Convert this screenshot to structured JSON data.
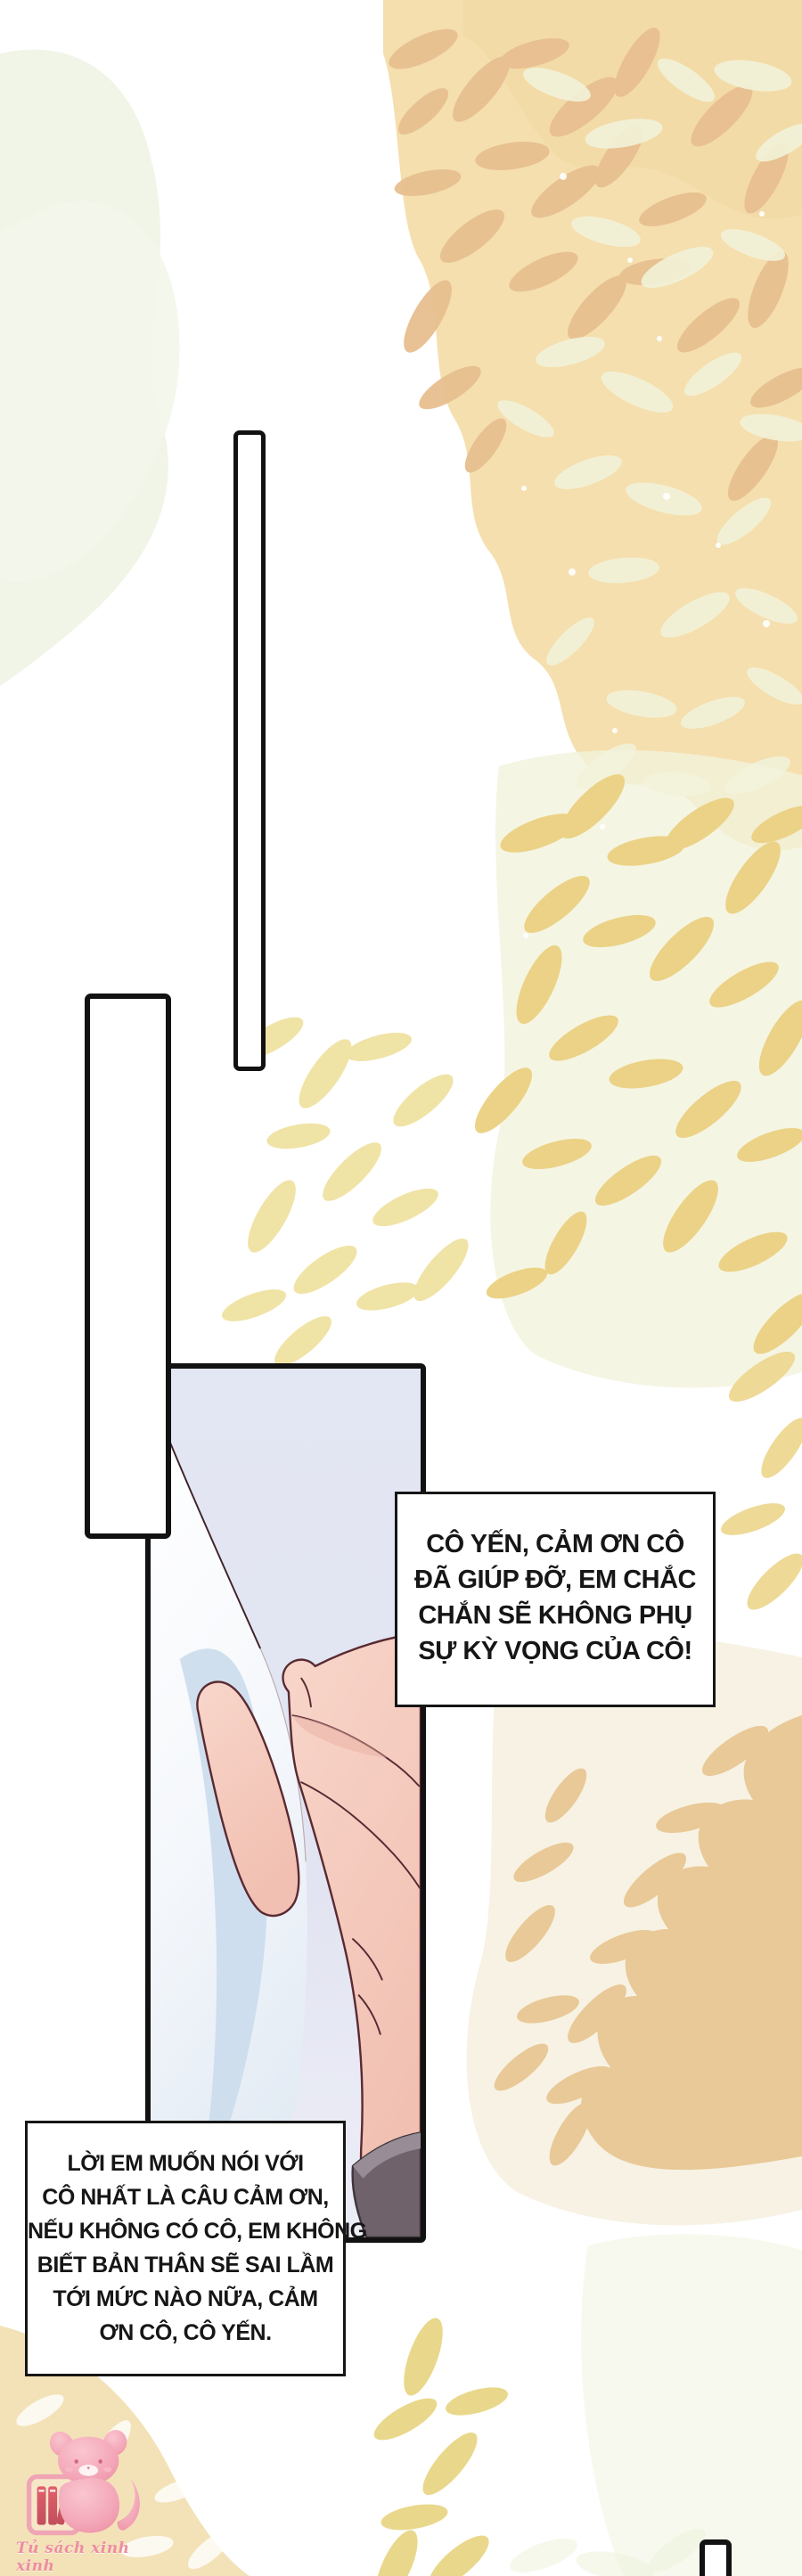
{
  "page": {
    "kind": "webtoon-comic-page",
    "language": "Vietnamese"
  },
  "bubbles": [
    {
      "name": "speech-bubble-1",
      "text": "CÔ YẾN, CẢM ƠN CÔ ĐÃ GIÚP ĐỠ, EM CHẮC CHẮN SẼ KHÔNG PHỤ SỰ KỲ VỌNG CỦA CÔ!",
      "lines": [
        "CÔ YẾN, CẢM ƠN CÔ",
        "ĐÃ GIÚP ĐỠ, EM CHẮC",
        "CHẮN SẼ KHÔNG PHỤ",
        "SỰ KỲ VỌNG CỦA CÔ!"
      ]
    },
    {
      "name": "speech-bubble-2",
      "text": "LỜI EM MUỐN NÓI VỚI CÔ NHẤT LÀ CÂU CẢM ƠN, NẾU KHÔNG CÓ CÔ, EM KHÔNG BIẾT BẢN THÂN SẼ SAI LẦM TỚI MỨC NÀO NỮA, CẢM ƠN CÔ, CÔ YẾN.",
      "lines": [
        "LỜI EM MUỐN NÓI VỚI",
        "CÔ NHẤT LÀ CÂU CẢM ƠN,",
        "NẾU KHÔNG CÓ CÔ, EM KHÔNG",
        "BIẾT BẢN THÂN SẼ SAI LẦM",
        "TỚI MỨC NÀO NỮA, CẢM",
        "ƠN CÔ, CÔ YẾN."
      ]
    }
  ],
  "watermark": {
    "text": "Tủ sách xinh xinh",
    "icon": "pink-cat-with-bookshelf"
  },
  "colors": {
    "panel_border": "#121212",
    "bubble_border": "#161616",
    "text": "#161616",
    "panel_background": "#e3e6f3",
    "paper_shadow_blue": "#cbdcec",
    "skin": "#f6cdc0",
    "skin_outline": "#5a2a33",
    "sleeve_gray": "#6f626b",
    "peach_wash": "#f5dfae",
    "leaf_tan": "#e7bf90",
    "leaf_gold": "#ebd286",
    "cream_corner": "#f3e2b7",
    "logo_pink": "#f0a0b2"
  }
}
